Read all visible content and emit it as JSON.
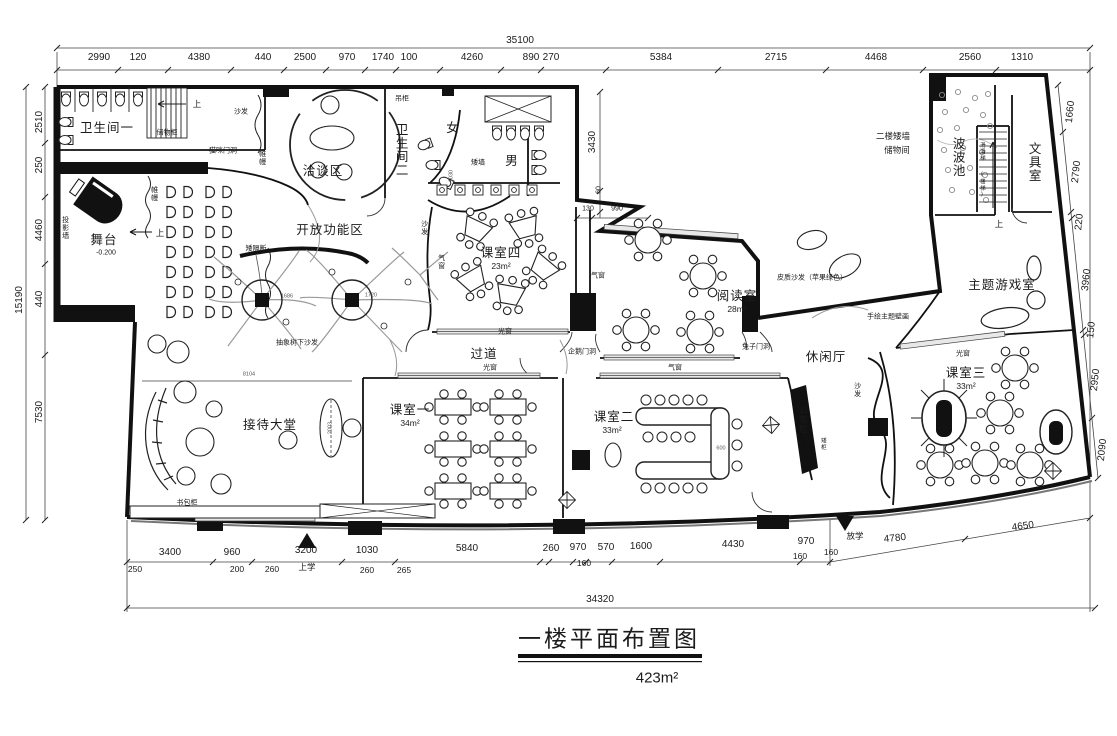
{
  "title": {
    "text": "一楼平面布置图",
    "area": "423m²"
  },
  "dims": {
    "top_total": "35100",
    "top": [
      "2990",
      "120",
      "4380",
      "440",
      "2500",
      "970",
      "1740",
      "100",
      "4260",
      "890",
      "270",
      "5384",
      "2715",
      "4468",
      "2560",
      "1310"
    ],
    "left_total": "15190",
    "left": [
      "2510",
      "250",
      "4460",
      "440",
      "7530"
    ],
    "right": [
      "1660",
      "2790",
      "220",
      "3960",
      "150",
      "2950",
      "2090"
    ],
    "bottom": [
      "3400",
      "960",
      "3200",
      "1030",
      "5840",
      "260",
      "970",
      "570",
      "1600",
      "4430",
      "970",
      "4780",
      "4650"
    ],
    "bottom_sub": [
      "250",
      "200",
      "260",
      "260",
      "265",
      "160",
      "160",
      "160"
    ],
    "bottom_total": "34320",
    "inner": {
      "v3430": "3430",
      "v60": "60",
      "v130": "130",
      "v990": "990",
      "v1030": "1030",
      "v8104": "8104",
      "v2003": "2003",
      "v600": "600",
      "v1686": "1686",
      "v1720": "1720"
    }
  },
  "rooms": {
    "bathroom1": "卫生间一",
    "bathroom2": "卫生间二",
    "female": "女",
    "male": "男",
    "negotiation": "洽谈区",
    "open_area": "开放功能区",
    "stage": "舞台",
    "stage_level": "-0.200",
    "classroom4": "课室四",
    "classroom4_area": "23m²",
    "reading": "阅读室",
    "reading_area": "28m²",
    "corridor": "过道",
    "reception": "接待大堂",
    "classroom1": "课室一",
    "classroom1_area": "34m²",
    "classroom2": "课室二",
    "classroom2_area": "33m²",
    "classroom3": "课室三",
    "classroom3_area": "33m²",
    "leisure": "休闲厅",
    "game": "主题游戏室",
    "stationery": "文具室",
    "ballpit": "波波池",
    "storage2f_l1": "二楼矮墙",
    "storage2f_l2": "储物间"
  },
  "ann": {
    "sofa": "沙发",
    "cat_door": "猫咪门洞",
    "curtain": "帷幔",
    "cabinet": "储物柜",
    "hanging": "吊柜",
    "low_wall": "矮墙",
    "partition": "矮隔断",
    "tree_sofa": "抽象树下沙发",
    "projection": "投影墙",
    "up": "上",
    "bag": "书包柜",
    "light_win": "光窗",
    "air_win": "气窗",
    "penguin": "企鹅门洞",
    "rabbit": "兔子门洞",
    "bulletin": "公告栏",
    "low_cab": "矮柜",
    "mural": "手绘主题壁画",
    "leather": "皮质沙发（苹果绿色）",
    "slide": "滑滑梯",
    "slide2": "(楼梯)",
    "go_school": "上学",
    "leave_school": "放学"
  }
}
